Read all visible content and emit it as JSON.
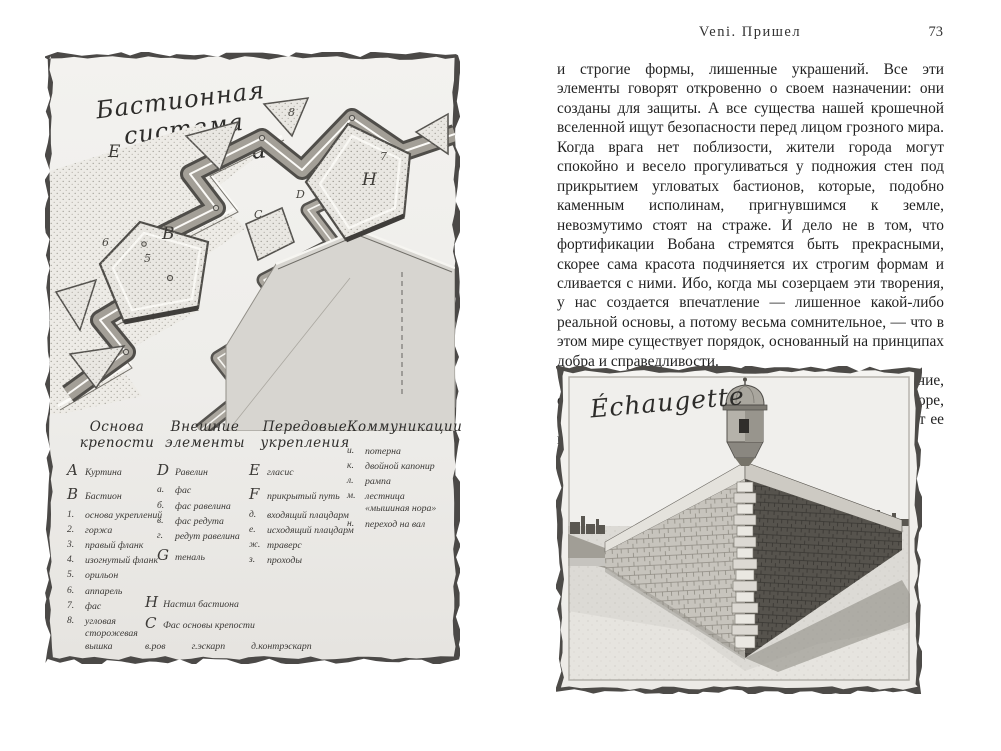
{
  "book": {
    "running_title": "Veni. Пришел",
    "page_number": "73"
  },
  "page_text": {
    "paragraph1": "и строгие формы, лишенные украшений. Все эти элементы говорят откровенно о своем назначении: они созданы для защиты. А все существа нашей крошечной вселенной ищут безопасности перед лицом грозного мира. Когда врага нет поблизости, жители города могут спокойно и весело прогуливаться у подножия стен под прикрытием угловатых бастионов, которые, подобно каменным исполинам, пригнувшимся к земле, невозмутимо стоят на страже. И дело не в том, что фортификации Вобана стремятся быть прекрасными, скорее сама красота подчиняется их строгим формам и сливается с ними. Ибо, когда мы созерцаем эти творения, у нас создается впечатление — лишенное какой-либо реальной основы, а потому весьма сомнительное, — что в этом мире существует порядок, основанный на принципах добра и справедливости.",
    "paragraph2": "А теперь позвольте мне поэтическое отступление, связанное с тем, что изображено на следующей гравюре, если только эта глупая курица не ошибется и поместит ее куда нужно."
  },
  "plate_bastion": {
    "title_line1": "Бастионная",
    "title_line2": "система укреплений",
    "diagram_labels": [
      {
        "t": "E",
        "x": 58,
        "y": 46,
        "big": true
      },
      {
        "t": "B",
        "x": 112,
        "y": 128,
        "big": true
      },
      {
        "t": "H",
        "x": 312,
        "y": 74,
        "big": true
      },
      {
        "t": "C",
        "x": 204,
        "y": 112
      },
      {
        "t": "D",
        "x": 246,
        "y": 92
      },
      {
        "t": "7",
        "x": 330,
        "y": 54
      },
      {
        "t": "5",
        "x": 94,
        "y": 156
      },
      {
        "t": "6",
        "x": 52,
        "y": 140
      },
      {
        "t": "8",
        "x": 238,
        "y": 10
      }
    ],
    "legend": {
      "columns": [
        {
          "h1": "Основа",
          "h2": "крепости",
          "items": [
            {
              "k": "A",
              "t": "Куртина",
              "big": true
            },
            {
              "k": "B",
              "t": "Бастион",
              "big": true
            },
            {
              "k": "1.",
              "t": "основа укреплений"
            },
            {
              "k": "2.",
              "t": "горжа"
            },
            {
              "k": "3.",
              "t": "правый фланк"
            },
            {
              "k": "4.",
              "t": "изогнутый фланк"
            },
            {
              "k": "5.",
              "t": "орильон"
            },
            {
              "k": "6.",
              "t": "аппарель"
            },
            {
              "k": "7.",
              "t": "фас"
            },
            {
              "k": "8.",
              "t": "угловая сторожевая вышка"
            }
          ]
        },
        {
          "h1": "Внешние",
          "h2": "элементы",
          "items": [
            {
              "k": "D",
              "t": "Равелин",
              "big": true
            },
            {
              "k": "а.",
              "t": "фас"
            },
            {
              "k": "б.",
              "t": "фас равелина"
            },
            {
              "k": "в.",
              "t": "фас редута"
            },
            {
              "k": "г.",
              "t": "редут равелина"
            },
            {
              "k": "G",
              "t": "теналь",
              "big": true
            }
          ]
        },
        {
          "h1": "Передовые",
          "h2": "укрепления",
          "items": [
            {
              "k": "E",
              "t": "гласис",
              "big": true
            },
            {
              "k": "F",
              "t": "прикрытый путь",
              "big": true
            },
            {
              "k": "д.",
              "t": "входящий плацдарм"
            },
            {
              "k": "е.",
              "t": "исходящий плацдарм"
            },
            {
              "k": "ж.",
              "t": "траверс"
            },
            {
              "k": "з.",
              "t": "проходы"
            }
          ]
        },
        {
          "h1": "Коммуникации",
          "h2": "",
          "items": [
            {
              "k": "и.",
              "t": "потерна"
            },
            {
              "k": "к.",
              "t": "двойной капонир"
            },
            {
              "k": "л.",
              "t": "рампа"
            },
            {
              "k": "м.",
              "t": "лестница «мышиная нора»"
            },
            {
              "k": "н.",
              "t": "переход на вал"
            }
          ]
        }
      ],
      "footer_items": [
        {
          "k": "H",
          "t": "Настил бастиона",
          "big": true
        },
        {
          "k": "C",
          "t": "Фас основы крепости",
          "big": true
        }
      ],
      "footer_row": [
        {
          "k": "в.",
          "t": "ров"
        },
        {
          "k": "г.",
          "t": "эскарп"
        },
        {
          "k": "д.",
          "t": "контрэскарп"
        }
      ]
    }
  },
  "plate_echaugette": {
    "title": "Échaugette"
  }
}
